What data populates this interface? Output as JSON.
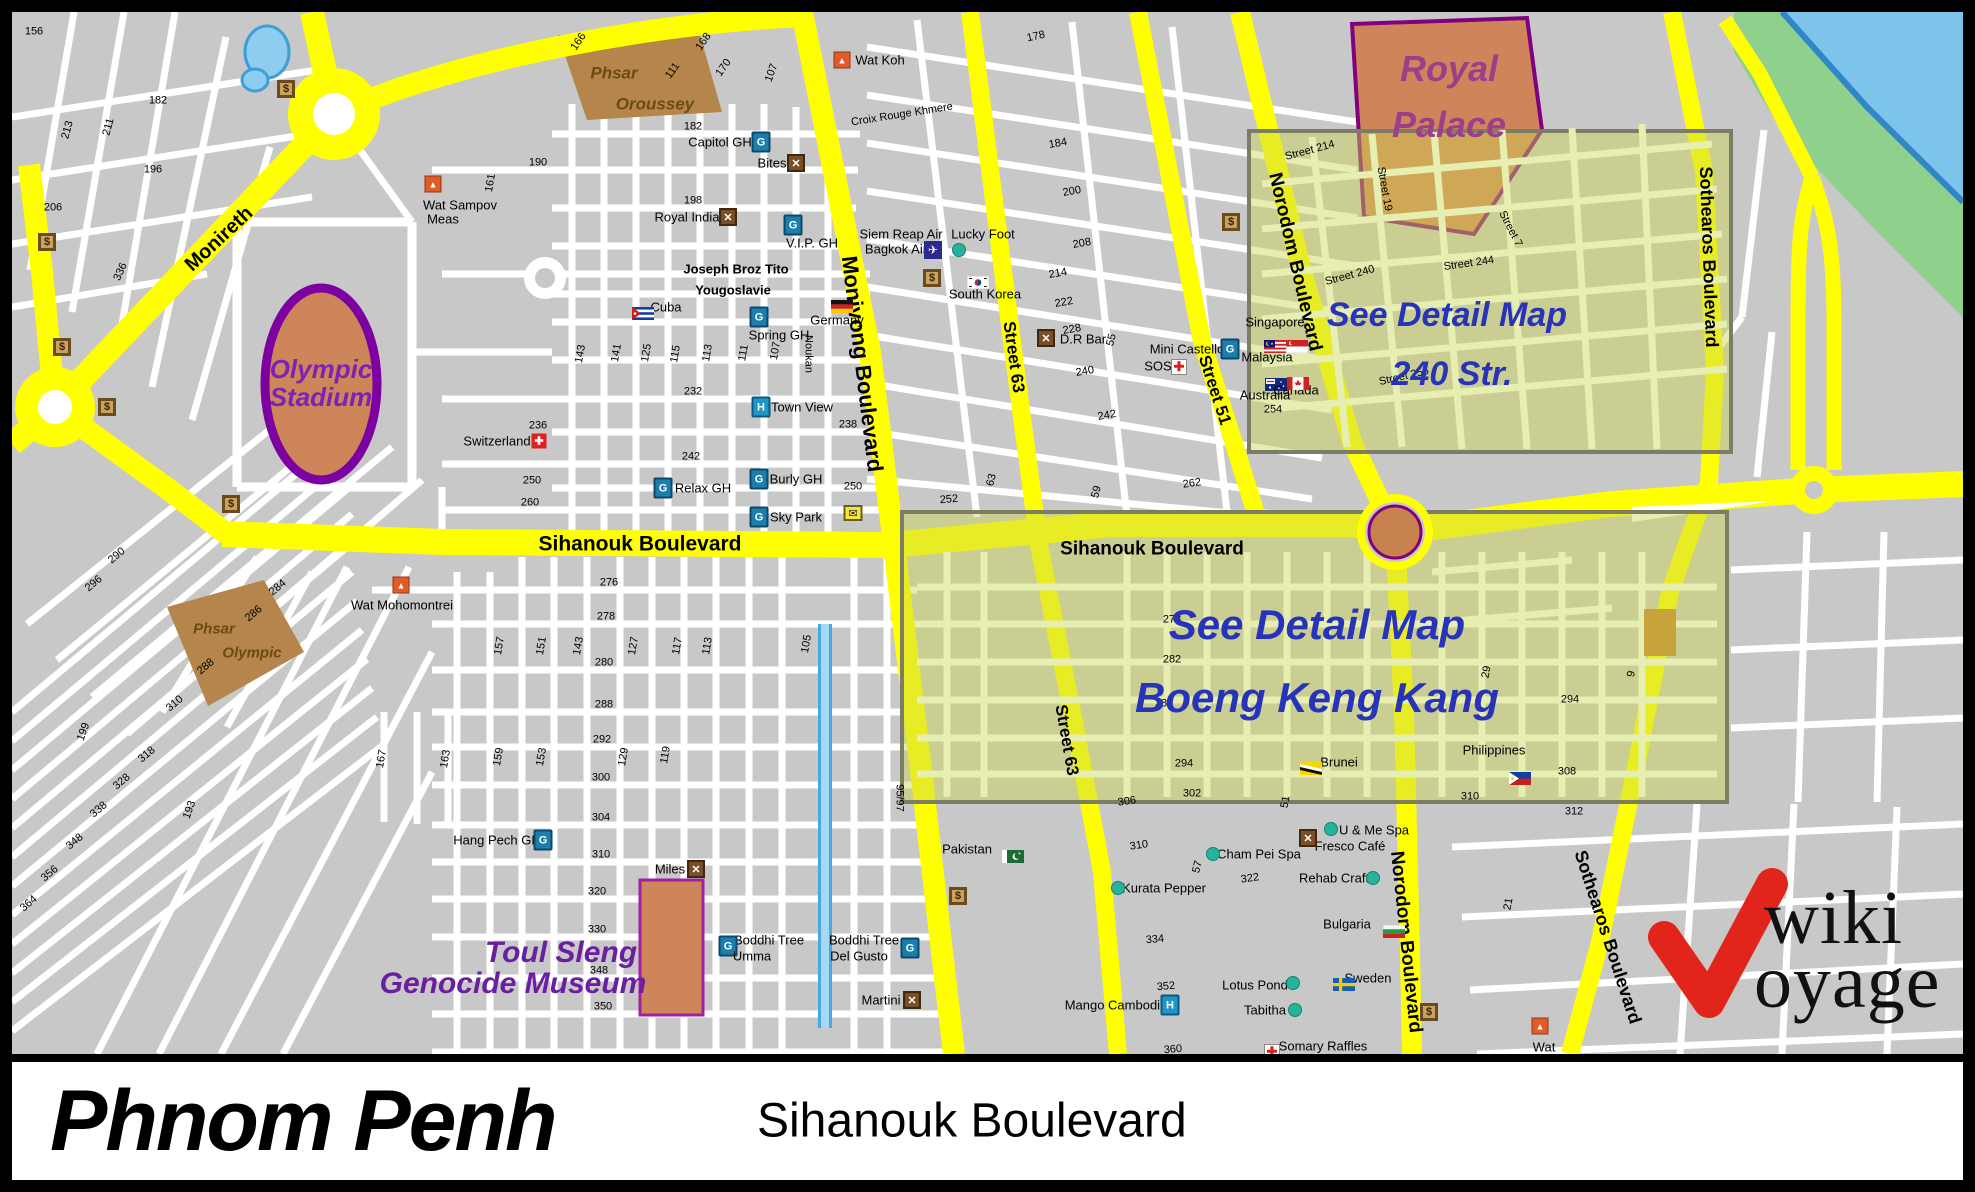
{
  "titlebar": {
    "city": "Phnom Penh",
    "subtitle": "Sihanouk Boulevard"
  },
  "logo": {
    "line1": "wiki",
    "line2": "oyage",
    "check_color": "#e1251b"
  },
  "colors": {
    "block_gray": "#c8c8c8",
    "street_white": "#ffffff",
    "road_yellow": "#ffff00",
    "water_blue": "#7cc4ea",
    "bank_green": "#8fd08c",
    "canal_blue": "#a5d8f2",
    "landmark_orange": "#cd8559",
    "market_tan": "#b5854b",
    "palace_border": "#800080",
    "detail_overlay": "rgba(205,212,82,0.42)",
    "detail_street": "#e7eeb2",
    "blue_text": "#2733b8",
    "purple_text": "#6a1fa0"
  },
  "boulevard_labels": [
    [
      "Monireth",
      207,
      227,
      -43,
      20
    ],
    [
      "Monivong Boulevard",
      850,
      352,
      83,
      22
    ],
    [
      "Sihanouk Boulevard",
      628,
      532,
      0,
      21
    ],
    [
      "Sihanouk Boulevard",
      1140,
      537,
      0,
      19
    ],
    [
      "Street 63",
      1002,
      345,
      82,
      17
    ],
    [
      "Street 63",
      1055,
      728,
      80,
      17
    ],
    [
      "Street 51",
      1203,
      378,
      72,
      17
    ],
    [
      "Norodom Boulevard",
      1283,
      250,
      77,
      19
    ],
    [
      "Norodom Boulevard",
      1394,
      930,
      84,
      19
    ],
    [
      "Sothearos Boulevard",
      1697,
      245,
      88,
      18
    ],
    [
      "Sothearos Boulevard",
      1596,
      925,
      72,
      18
    ]
  ],
  "street_names": [
    [
      "Croix Rouge Khmere",
      890,
      103,
      -9,
      "st"
    ],
    [
      "Joseph Broz Tito",
      724,
      257,
      0,
      "stb"
    ],
    [
      "Yougoslavie",
      721,
      278,
      0,
      "stb"
    ],
    [
      "Noukan",
      796,
      342,
      90,
      "st"
    ],
    [
      "Street 214",
      1298,
      139,
      -15,
      "st"
    ],
    [
      "Street 19",
      1372,
      177,
      80,
      "st"
    ],
    [
      "Street 240",
      1338,
      264,
      -15,
      "st"
    ],
    [
      "Street 244",
      1457,
      252,
      -8,
      "st"
    ],
    [
      "Street 7",
      1498,
      217,
      63,
      "st"
    ],
    [
      "Street 256",
      1392,
      365,
      -13,
      "st"
    ],
    [
      "95/97",
      887,
      786,
      90,
      "st"
    ]
  ],
  "street_numbers": [
    [
      "156",
      22,
      20,
      0
    ],
    [
      "182",
      146,
      89,
      0
    ],
    [
      "213",
      56,
      118,
      75
    ],
    [
      "211",
      97,
      115,
      75
    ],
    [
      "196",
      141,
      158,
      0
    ],
    [
      "206",
      41,
      196,
      0
    ],
    [
      "336",
      109,
      260,
      65
    ],
    [
      "166",
      567,
      30,
      55
    ],
    [
      "111",
      661,
      59,
      55
    ],
    [
      "168",
      692,
      30,
      55
    ],
    [
      "170",
      712,
      56,
      55
    ],
    [
      "107",
      760,
      61,
      70
    ],
    [
      "182",
      681,
      115,
      0
    ],
    [
      "190",
      526,
      151,
      0
    ],
    [
      "161",
      479,
      171,
      80
    ],
    [
      "198",
      681,
      189,
      0
    ],
    [
      "178",
      1024,
      25,
      12
    ],
    [
      "184",
      1046,
      132,
      10
    ],
    [
      "200",
      1060,
      180,
      10
    ],
    [
      "208",
      1070,
      232,
      10
    ],
    [
      "214",
      1046,
      262,
      10
    ],
    [
      "222",
      1052,
      291,
      10
    ],
    [
      "228",
      1060,
      318,
      10
    ],
    [
      "240",
      1073,
      360,
      10
    ],
    [
      "242",
      1095,
      404,
      10
    ],
    [
      "55",
      1100,
      328,
      75
    ],
    [
      "252",
      937,
      488,
      5
    ],
    [
      "262",
      1180,
      472,
      8
    ],
    [
      "59",
      1085,
      480,
      75
    ],
    [
      "63",
      980,
      468,
      75
    ],
    [
      "232",
      681,
      380,
      0
    ],
    [
      "236",
      526,
      414,
      0
    ],
    [
      "238",
      836,
      413,
      0
    ],
    [
      "242",
      679,
      445,
      0
    ],
    [
      "250",
      520,
      469,
      0
    ],
    [
      "260",
      518,
      491,
      0
    ],
    [
      "250",
      841,
      475,
      0
    ],
    [
      "143",
      569,
      342,
      80
    ],
    [
      "141",
      605,
      341,
      80
    ],
    [
      "125",
      635,
      341,
      80
    ],
    [
      "115",
      664,
      342,
      80
    ],
    [
      "113",
      696,
      341,
      80
    ],
    [
      "111",
      732,
      341,
      80
    ],
    [
      "107",
      764,
      339,
      80
    ],
    [
      "290",
      105,
      544,
      40
    ],
    [
      "296",
      82,
      572,
      40
    ],
    [
      "284",
      266,
      576,
      40
    ],
    [
      "286",
      242,
      602,
      40
    ],
    [
      "288",
      194,
      655,
      40
    ],
    [
      "310",
      163,
      692,
      40
    ],
    [
      "318",
      135,
      743,
      40
    ],
    [
      "328",
      110,
      770,
      40
    ],
    [
      "338",
      87,
      798,
      40
    ],
    [
      "348",
      63,
      830,
      40
    ],
    [
      "356",
      38,
      862,
      40
    ],
    [
      "364",
      17,
      892,
      40
    ],
    [
      "199",
      72,
      720,
      70
    ],
    [
      "193",
      178,
      798,
      70
    ],
    [
      "276",
      597,
      571,
      0
    ],
    [
      "278",
      594,
      605,
      0
    ],
    [
      "280",
      592,
      651,
      0
    ],
    [
      "288",
      592,
      693,
      0
    ],
    [
      "292",
      590,
      728,
      0
    ],
    [
      "300",
      589,
      766,
      0
    ],
    [
      "304",
      589,
      806,
      0
    ],
    [
      "310",
      589,
      843,
      0
    ],
    [
      "320",
      585,
      880,
      0
    ],
    [
      "330",
      585,
      918,
      0
    ],
    [
      "348",
      587,
      959,
      0
    ],
    [
      "350",
      591,
      995,
      0
    ],
    [
      "157",
      488,
      634,
      80
    ],
    [
      "151",
      530,
      634,
      80
    ],
    [
      "143",
      567,
      634,
      80
    ],
    [
      "127",
      622,
      634,
      80
    ],
    [
      "117",
      666,
      634,
      80
    ],
    [
      "113",
      696,
      634,
      80
    ],
    [
      "105",
      795,
      632,
      80
    ],
    [
      "163",
      434,
      747,
      80
    ],
    [
      "159",
      487,
      745,
      80
    ],
    [
      "153",
      530,
      745,
      80
    ],
    [
      "129",
      612,
      745,
      80
    ],
    [
      "119",
      654,
      743,
      80
    ],
    [
      "167",
      370,
      747,
      80
    ],
    [
      "306",
      1115,
      790,
      8
    ],
    [
      "310",
      1127,
      834,
      8
    ],
    [
      "322",
      1238,
      867,
      8
    ],
    [
      "334",
      1143,
      928,
      5
    ],
    [
      "352",
      1154,
      975,
      5
    ],
    [
      "360",
      1161,
      1038,
      5
    ],
    [
      "51",
      1274,
      790,
      80
    ],
    [
      "57",
      1186,
      855,
      75
    ],
    [
      "278",
      1160,
      608,
      0
    ],
    [
      "282",
      1160,
      648,
      0
    ],
    [
      "288",
      1152,
      692,
      0
    ],
    [
      "294",
      1172,
      752,
      0
    ],
    [
      "302",
      1180,
      782,
      0
    ],
    [
      "294",
      1558,
      688,
      0
    ],
    [
      "308",
      1555,
      760,
      0
    ],
    [
      "312",
      1562,
      800,
      0
    ],
    [
      "310",
      1458,
      785,
      0
    ],
    [
      "29",
      1475,
      660,
      80
    ],
    [
      "9",
      1620,
      662,
      80
    ],
    [
      "21",
      1497,
      892,
      80
    ],
    [
      "254",
      1261,
      398,
      0
    ]
  ],
  "landmark_labels": [
    [
      "Royal",
      1437,
      57,
      "lm-purple-pal",
      0
    ],
    [
      "Palace",
      1437,
      113,
      "lm-purple-pal",
      0
    ],
    [
      "Olympic",
      309,
      357,
      "lm-purple-md",
      0
    ],
    [
      "Stadium",
      309,
      385,
      "lm-purple-md",
      0
    ],
    [
      "Phsar",
      602,
      61,
      "lm-brown",
      0
    ],
    [
      "Oroussey",
      643,
      92,
      "lm-brown",
      0
    ],
    [
      "Phsar",
      202,
      617,
      "lm-brown-sm",
      0
    ],
    [
      "Olympic",
      240,
      641,
      "lm-brown-sm",
      0
    ],
    [
      "Toul Sleng",
      549,
      941,
      "lm-purple-lg",
      0
    ],
    [
      "Genocide Museum",
      501,
      972,
      "lm-purple-lg",
      0
    ],
    [
      "See Detail Map",
      1435,
      303,
      "lm-blue-lg",
      0
    ],
    [
      "240 Str.",
      1440,
      362,
      "lm-blue-lg",
      0
    ],
    [
      "See Detail Map",
      1305,
      613,
      "lm-blue-xl",
      0
    ],
    [
      "Boeng Keng Kang",
      1305,
      686,
      "lm-blue-xl",
      0
    ]
  ],
  "pois": [
    {
      "t": "Wat Koh",
      "x": 868,
      "y": 48,
      "icon": "wat",
      "ix": 830,
      "iy": 48
    },
    {
      "t": "Capitol GH",
      "x": 708,
      "y": 130,
      "icon": "gh",
      "ix": 749,
      "iy": 130
    },
    {
      "t": "Bites",
      "x": 760,
      "y": 151,
      "icon": "rest",
      "ix": 784,
      "iy": 151
    },
    {
      "t": "Wat Sampov",
      "x": 448,
      "y": 193,
      "icon": "wat",
      "ix": 421,
      "iy": 172
    },
    {
      "t": "Meas",
      "x": 431,
      "y": 207,
      "icon": "",
      "ix": 0,
      "iy": 0
    },
    {
      "t": "Royal India",
      "x": 675,
      "y": 205,
      "icon": "rest",
      "ix": 716,
      "iy": 205
    },
    {
      "t": "V.I.P. GH",
      "x": 800,
      "y": 231,
      "icon": "gh",
      "ix": 781,
      "iy": 213
    },
    {
      "t": "Siem Reap Air",
      "x": 889,
      "y": 222,
      "icon": "",
      "ix": 0,
      "iy": 0
    },
    {
      "t": "Bagkok Air",
      "x": 884,
      "y": 237,
      "icon": "plane",
      "ix": 921,
      "iy": 238
    },
    {
      "t": "Lucky Foot",
      "x": 971,
      "y": 222,
      "icon": "dot",
      "ix": 947,
      "iy": 238
    },
    {
      "t": "South Korea",
      "x": 973,
      "y": 282,
      "icon": "flag:korea",
      "ix": 955,
      "iy": 264
    },
    {
      "t": "",
      "x": 0,
      "y": 0,
      "icon": "money",
      "ix": 920,
      "iy": 266
    },
    {
      "t": "D.R Bar",
      "x": 1071,
      "y": 327,
      "icon": "rest",
      "ix": 1034,
      "iy": 326
    },
    {
      "t": "SOS",
      "x": 1146,
      "y": 354,
      "icon": "cross",
      "ix": 1167,
      "iy": 355
    },
    {
      "t": "Mini Castello",
      "x": 1175,
      "y": 337,
      "icon": "gh",
      "ix": 1218,
      "iy": 337
    },
    {
      "t": "Cuba",
      "x": 654,
      "y": 295,
      "icon": "flag:cuba",
      "ix": 620,
      "iy": 295
    },
    {
      "t": "Germany",
      "x": 825,
      "y": 308,
      "icon": "flag:germany",
      "ix": 819,
      "iy": 288
    },
    {
      "t": "Spring GH",
      "x": 767,
      "y": 323,
      "icon": "gh",
      "ix": 747,
      "iy": 305
    },
    {
      "t": "Town View",
      "x": 790,
      "y": 395,
      "icon": "hotel",
      "ix": 749,
      "iy": 395
    },
    {
      "t": "Switzerland",
      "x": 485,
      "y": 429,
      "icon": "swiss",
      "ix": 527,
      "iy": 429
    },
    {
      "t": "Relax GH",
      "x": 691,
      "y": 476,
      "icon": "gh",
      "ix": 651,
      "iy": 476
    },
    {
      "t": "Burly GH",
      "x": 784,
      "y": 467,
      "icon": "gh",
      "ix": 747,
      "iy": 467
    },
    {
      "t": "Sky Park",
      "x": 784,
      "y": 505,
      "icon": "gh",
      "ix": 747,
      "iy": 505
    },
    {
      "t": "",
      "x": 0,
      "y": 0,
      "icon": "mail",
      "ix": 841,
      "iy": 501
    },
    {
      "t": "Wat Mohomontrei",
      "x": 390,
      "y": 593,
      "icon": "wat",
      "ix": 389,
      "iy": 573
    },
    {
      "t": "Hang Pech GH",
      "x": 485,
      "y": 828,
      "icon": "gh",
      "ix": 531,
      "iy": 828
    },
    {
      "t": "Miles",
      "x": 658,
      "y": 857,
      "icon": "rest",
      "ix": 684,
      "iy": 857
    },
    {
      "t": "Boddhi Tree",
      "x": 757,
      "y": 928,
      "icon": "gh",
      "ix": 716,
      "iy": 934
    },
    {
      "t": "Umma",
      "x": 740,
      "y": 944,
      "icon": "",
      "ix": 0,
      "iy": 0
    },
    {
      "t": "Boddhi Tree",
      "x": 852,
      "y": 928,
      "icon": "gh",
      "ix": 898,
      "iy": 936
    },
    {
      "t": "Del Gusto",
      "x": 847,
      "y": 944,
      "icon": "",
      "ix": 0,
      "iy": 0
    },
    {
      "t": "Martini",
      "x": 869,
      "y": 988,
      "icon": "rest",
      "ix": 900,
      "iy": 988
    },
    {
      "t": "Pakistan",
      "x": 955,
      "y": 837,
      "icon": "flag:pakistan",
      "ix": 990,
      "iy": 838
    },
    {
      "t": "",
      "x": 0,
      "y": 0,
      "icon": "money",
      "ix": 946,
      "iy": 884
    },
    {
      "t": "Kurata Pepper",
      "x": 1152,
      "y": 876,
      "icon": "dot",
      "ix": 1106,
      "iy": 876
    },
    {
      "t": "Cham Pei Spa",
      "x": 1247,
      "y": 842,
      "icon": "dot",
      "ix": 1201,
      "iy": 842
    },
    {
      "t": "U & Me Spa",
      "x": 1362,
      "y": 818,
      "icon": "dot",
      "ix": 1319,
      "iy": 817
    },
    {
      "t": "Fresco Café",
      "x": 1338,
      "y": 834,
      "icon": "rest",
      "ix": 1296,
      "iy": 826
    },
    {
      "t": "Rehab Craft",
      "x": 1322,
      "y": 866,
      "icon": "dot",
      "ix": 1361,
      "iy": 866
    },
    {
      "t": "Bulgaria",
      "x": 1335,
      "y": 912,
      "icon": "flag:bulgaria",
      "ix": 1371,
      "iy": 913
    },
    {
      "t": "Lotus Pond",
      "x": 1243,
      "y": 973,
      "icon": "dot",
      "ix": 1281,
      "iy": 971
    },
    {
      "t": "Tabitha",
      "x": 1253,
      "y": 998,
      "icon": "dot",
      "ix": 1283,
      "iy": 998
    },
    {
      "t": "Sweden",
      "x": 1356,
      "y": 966,
      "icon": "flag:sweden",
      "ix": 1321,
      "iy": 966
    },
    {
      "t": "Mango Cambodia",
      "x": 1104,
      "y": 993,
      "icon": "hotel",
      "ix": 1158,
      "iy": 993
    },
    {
      "t": "Somary Raffles",
      "x": 1311,
      "y": 1034,
      "icon": "cross",
      "ix": 1260,
      "iy": 1040
    },
    {
      "t": "Medical Clinic",
      "x": 1309,
      "y": 1050,
      "icon": "",
      "ix": 0,
      "iy": 0
    },
    {
      "t": "",
      "x": 0,
      "y": 0,
      "icon": "money",
      "ix": 1417,
      "iy": 1000
    },
    {
      "t": "Wat",
      "x": 1532,
      "y": 1035,
      "icon": "wat",
      "ix": 1528,
      "iy": 1014
    },
    {
      "t": "Svay Porper",
      "x": 1532,
      "y": 1050,
      "icon": "",
      "ix": 0,
      "iy": 0
    },
    {
      "t": "Brunei",
      "x": 1327,
      "y": 750,
      "icon": "flag:brunei",
      "ix": 1288,
      "iy": 750
    },
    {
      "t": "Philippines",
      "x": 1482,
      "y": 738,
      "icon": "flag:philippines",
      "ix": 1497,
      "iy": 760
    },
    {
      "t": "Singapore",
      "x": 1263,
      "y": 310,
      "icon": "flag:singapore",
      "ix": 1274,
      "iy": 328
    },
    {
      "t": "Malaysia",
      "x": 1255,
      "y": 345,
      "icon": "flag:malaysia",
      "ix": 1252,
      "iy": 328
    },
    {
      "t": "Australia",
      "x": 1253,
      "y": 383,
      "icon": "flag:australia",
      "ix": 1253,
      "iy": 366
    },
    {
      "t": "Canada",
      "x": 1284,
      "y": 378,
      "icon": "flag:canada",
      "ix": 1275,
      "iy": 365
    },
    {
      "t": "",
      "x": 0,
      "y": 0,
      "icon": "money",
      "ix": 274,
      "iy": 77
    },
    {
      "t": "",
      "x": 0,
      "y": 0,
      "icon": "money",
      "ix": 35,
      "iy": 230
    },
    {
      "t": "",
      "x": 0,
      "y": 0,
      "icon": "money",
      "ix": 50,
      "iy": 335
    },
    {
      "t": "",
      "x": 0,
      "y": 0,
      "icon": "money",
      "ix": 95,
      "iy": 395
    },
    {
      "t": "",
      "x": 0,
      "y": 0,
      "icon": "money",
      "ix": 219,
      "iy": 492
    },
    {
      "t": "",
      "x": 0,
      "y": 0,
      "icon": "money",
      "ix": 1219,
      "iy": 210
    }
  ]
}
